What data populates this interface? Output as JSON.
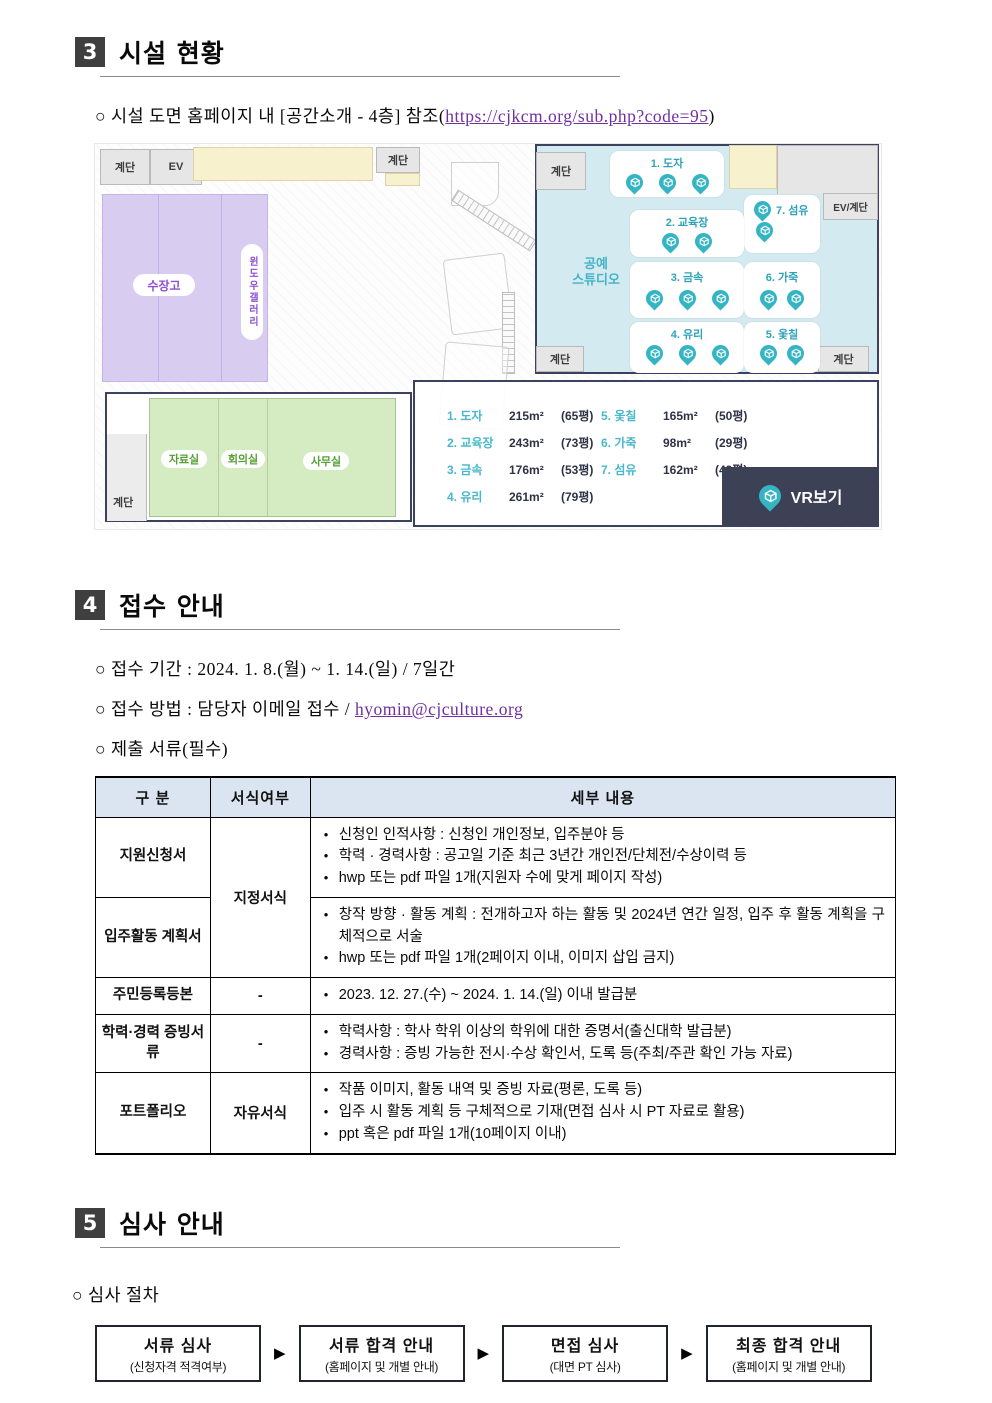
{
  "sections": {
    "facility": {
      "number": "3",
      "title": "시설 현황",
      "marker": "○",
      "note_prefix": "시설 도면 홈페이지 내 [공간소개 - 4층] 참조(",
      "note_link": "https://cjkcm.org/sub.php?code=95",
      "note_suffix": ")"
    },
    "reception": {
      "number": "4",
      "title": "접수 안내",
      "marker": "○",
      "bullet_period": "접수 기간 : 2024. 1. 8.(월) ~ 1. 14.(일) / 7일간",
      "bullet_method_prefix": "접수 방법 : 담당자 이메일 접수 / ",
      "bullet_method_link": "hyomin@cjculture.org",
      "bullet_docs": "제출 서류(필수)"
    },
    "review": {
      "number": "5",
      "title": "심사 안내",
      "marker": "○",
      "bullet": "심사 절차",
      "arrow": "▶",
      "steps": [
        {
          "title": "서류 심사",
          "subtitle": "(신청자격 적격여부)"
        },
        {
          "title": "서류 합격 안내",
          "subtitle": "(홈페이지 및 개별 안내)"
        },
        {
          "title": "면접 심사",
          "subtitle": "(대면 PT 심사)"
        },
        {
          "title": "최종 합격 안내",
          "subtitle": "(홈페이지 및 개별 안내)"
        }
      ]
    }
  },
  "floorplan": {
    "labels": {
      "stairs": "계단",
      "elevator": "EV",
      "ev_stairs": "EV/계단",
      "storage": "수장고",
      "window_gallery": "윈도우갤러리",
      "studio_line1": "공예",
      "studio_line2": "스튜디오",
      "archive": "자료실",
      "meeting": "회의실",
      "office": "사무실"
    },
    "zones": [
      {
        "label": "1. 도자",
        "pins": 3
      },
      {
        "label": "2. 교육장",
        "pins": 2
      },
      {
        "label": "3. 금속",
        "pins": 3
      },
      {
        "label": "4. 유리",
        "pins": 3
      },
      {
        "label": "5. 옻칠",
        "pins": 2
      },
      {
        "label": "6. 가죽",
        "pins": 2
      },
      {
        "label": "7. 섬유",
        "pins": 2
      }
    ],
    "legend": [
      {
        "label": "1. 도자",
        "area": "215m²",
        "pyeong": "(65평)"
      },
      {
        "label": "2. 교육장",
        "area": "243m²",
        "pyeong": "(73평)"
      },
      {
        "label": "3. 금속",
        "area": "176m²",
        "pyeong": "(53평)"
      },
      {
        "label": "4. 유리",
        "area": "261m²",
        "pyeong": "(79평)"
      },
      {
        "label": "5. 옻칠",
        "area": "165m²",
        "pyeong": "(50평)"
      },
      {
        "label": "6. 가죽",
        "area": "98m²",
        "pyeong": "(29평)"
      },
      {
        "label": "7. 섬유",
        "area": "162m²",
        "pyeong": "(49평)"
      }
    ],
    "vr_button": "VR보기",
    "colors": {
      "pin": "#35b5c4",
      "studio_bg": "#d3eaf1",
      "studio_border": "#3c4160",
      "purple_room": "#d8ccf0",
      "green_room": "#d5ecc3",
      "yellow_room": "#f7f1cd",
      "vr_button_bg": "#3d4156"
    }
  },
  "table": {
    "headers": [
      "구 분",
      "서식여부",
      "세부 내용"
    ],
    "rows": [
      {
        "category": "지원신청서",
        "format": "지정서식",
        "items": [
          "신청인 인적사항 : 신청인 개인정보, 입주분야 등",
          "학력 · 경력사항 : 공고일 기준 최근 3년간 개인전/단체전/수상이력 등",
          "hwp 또는 pdf 파일 1개(지원자 수에 맞게 페이지 작성)"
        ]
      },
      {
        "category": "입주활동 계획서",
        "items": [
          "창작 방향 · 활동 계획 : 전개하고자 하는 활동 및 2024년 연간 일정, 입주 후 활동 계획을 구체적으로 서술",
          "hwp 또는 pdf 파일 1개(2페이지 이내, 이미지 삽입 금지)"
        ]
      },
      {
        "category": "주민등록등본",
        "format": "-",
        "items": [
          "2023. 12. 27.(수) ~ 2024. 1. 14.(일) 이내 발급분"
        ]
      },
      {
        "category": "학력·경력 증빙서류",
        "format": "-",
        "items": [
          "학력사항 : 학사 학위 이상의 학위에 대한 증명서(출신대학 발급분)",
          "경력사항 : 증빙 가능한 전시·수상 확인서, 도록 등(주최/주관 확인 가능 자료)"
        ]
      },
      {
        "category": "포트폴리오",
        "format": "자유서식",
        "items": [
          "작품 이미지, 활동 내역 및 증빙 자료(평론, 도록 등)",
          "입주 시 활동 계획 등 구체적으로 기재(면접 심사 시 PT 자료로 활용)",
          "ppt 혹은 pdf 파일 1개(10페이지 이내)"
        ]
      }
    ]
  }
}
